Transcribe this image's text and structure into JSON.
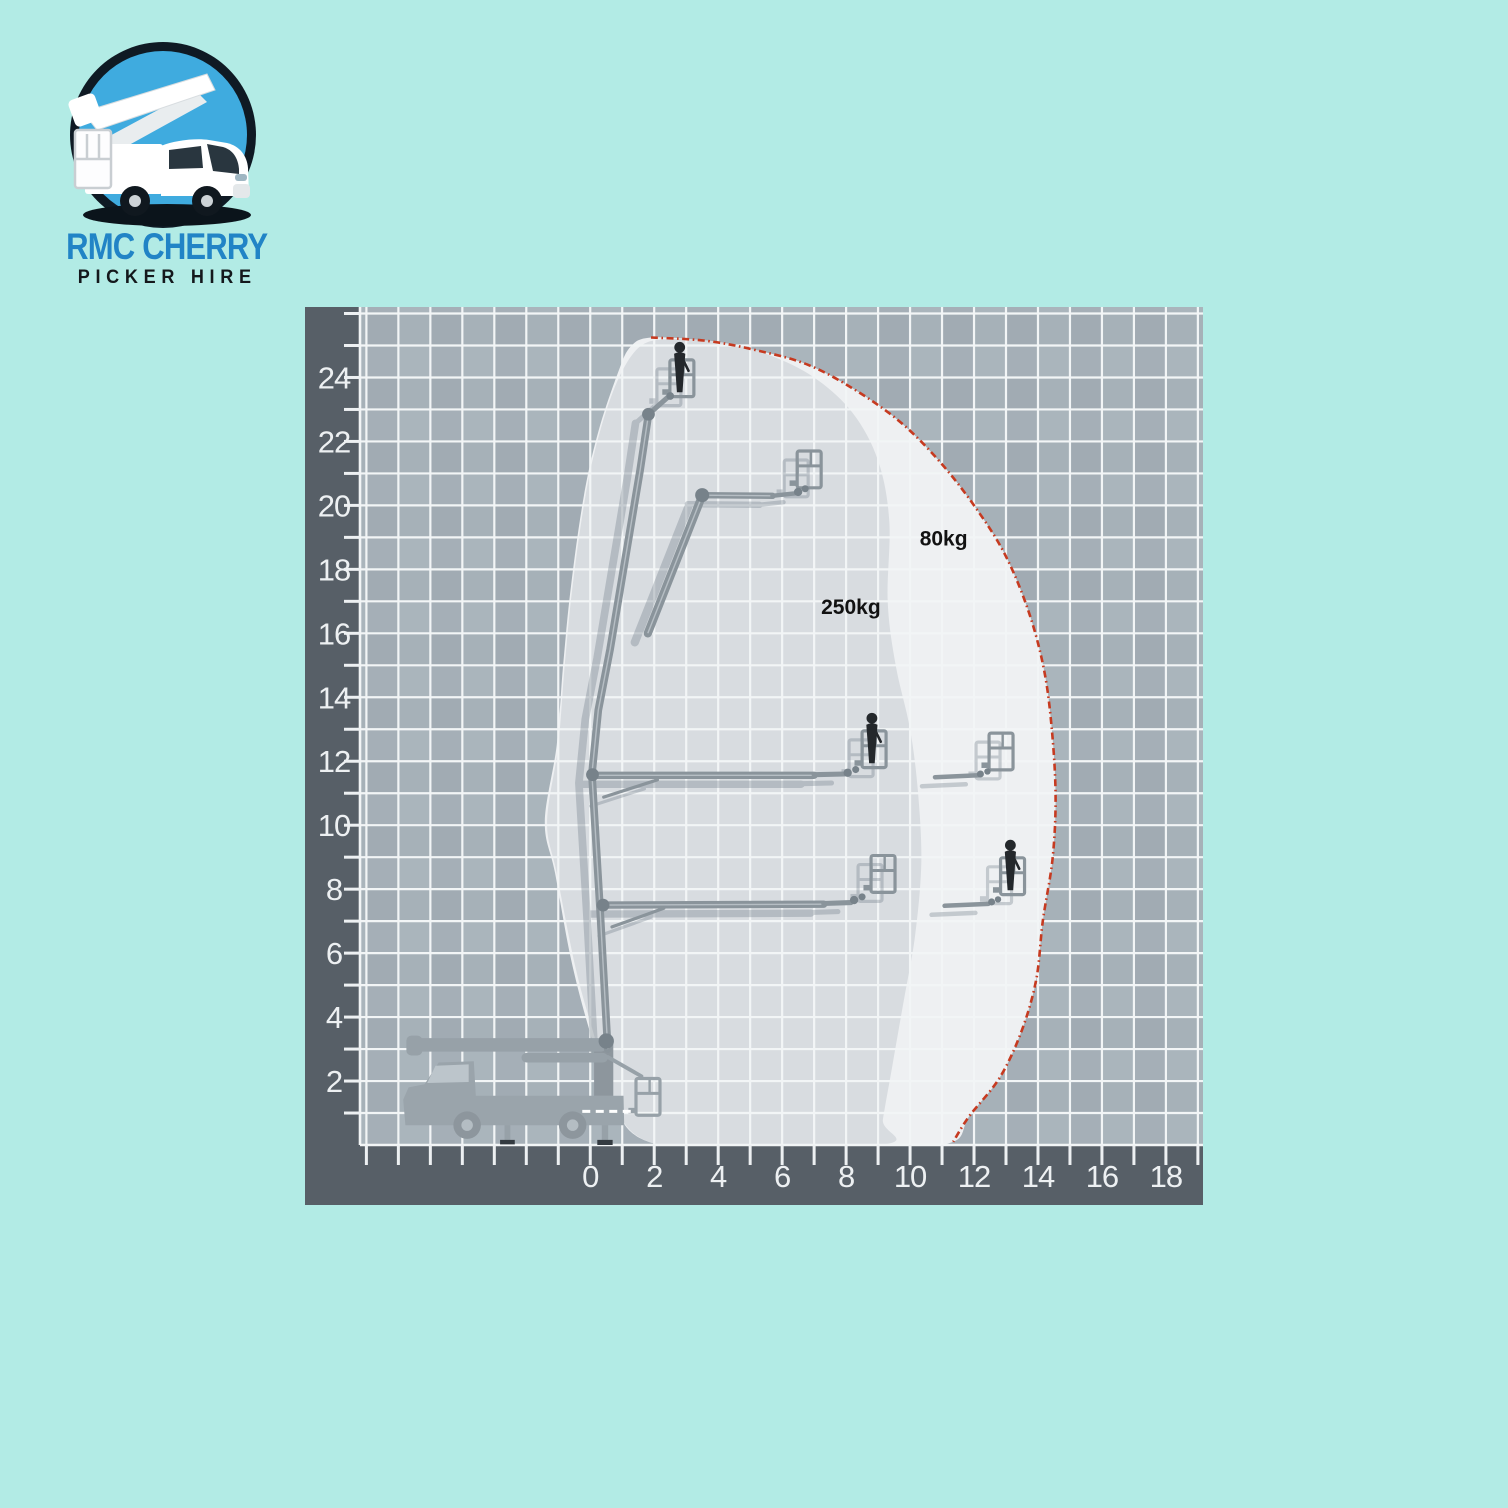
{
  "page": {
    "background": "#b2ebe5"
  },
  "logo": {
    "line1": "RMC CHERRY",
    "line2": "PICKER HIRE",
    "line1_color": "#2184c6",
    "line2_color": "#14181c",
    "circle_fill": "#3fabdf",
    "ring_color": "#0f1a24",
    "truck_color": "#ffffff"
  },
  "chart_data": {
    "type": "area",
    "title": "",
    "xlabel": "",
    "ylabel": "",
    "xlim": [
      -7.2,
      19.16
    ],
    "ylim": [
      0,
      26.19
    ],
    "x_tick_labels": [
      0,
      2,
      4,
      6,
      8,
      10,
      12,
      14,
      16,
      18
    ],
    "y_tick_labels": [
      2,
      4,
      6,
      8,
      10,
      12,
      14,
      16,
      18,
      20,
      22,
      24
    ],
    "minor_tick_step": 1,
    "grid": "on",
    "legend_position": "none",
    "colors": {
      "band": "#575f67",
      "grid_bg": "#aab5bc",
      "grid_line": "#f2f5f6",
      "tick_text": "#edf0f2",
      "limit_line": "#c63a20",
      "label_text": "#121212",
      "machine": "#8a949b",
      "machine_light": "#97a1a8",
      "truck": "#9aa4ab",
      "joint": "#77828a",
      "person": "#24282c",
      "shadow": "#6c7884"
    },
    "zones": [
      {
        "name": "80kg",
        "label": "80kg",
        "label_pos": [
          11.05,
          18.75
        ],
        "fill": "#eef0f2",
        "points": [
          [
            1.9,
            25.25
          ],
          [
            3.6,
            25.15
          ],
          [
            5.2,
            24.85
          ],
          [
            6.8,
            24.4
          ],
          [
            8.3,
            23.6
          ],
          [
            9.7,
            22.6
          ],
          [
            10.9,
            21.4
          ],
          [
            12.0,
            20.0
          ],
          [
            12.95,
            18.5
          ],
          [
            13.7,
            16.7
          ],
          [
            14.2,
            14.8
          ],
          [
            14.45,
            12.8
          ],
          [
            14.55,
            10.8
          ],
          [
            14.45,
            8.9
          ],
          [
            14.15,
            7.0
          ],
          [
            13.95,
            5.2
          ],
          [
            13.5,
            3.6
          ],
          [
            12.8,
            2.1
          ],
          [
            11.85,
            0.9
          ],
          [
            11.35,
            0.1
          ],
          [
            9.5,
            0
          ],
          [
            2.2,
            0
          ],
          [
            0.6,
            1.8
          ],
          [
            0.0,
            3.5
          ],
          [
            -0.6,
            5.8
          ],
          [
            -1.1,
            8.5
          ],
          [
            -1.42,
            10.1
          ],
          [
            -1.05,
            12.5
          ],
          [
            -0.85,
            15.0
          ],
          [
            -0.6,
            17.5
          ],
          [
            -0.2,
            20.3
          ],
          [
            0.25,
            22.3
          ],
          [
            0.85,
            24.1
          ],
          [
            1.25,
            24.95
          ]
        ]
      },
      {
        "name": "250kg",
        "label": "250kg",
        "label_pos": [
          8.15,
          16.6
        ],
        "fill": "#d8dce0",
        "points": [
          [
            2.2,
            0
          ],
          [
            0.6,
            1.8
          ],
          [
            0.1,
            3.5
          ],
          [
            -0.45,
            5.5
          ],
          [
            -1.05,
            8.5
          ],
          [
            -1.35,
            10.1
          ],
          [
            -1.0,
            12.5
          ],
          [
            -0.8,
            15.0
          ],
          [
            -0.55,
            17.5
          ],
          [
            -0.15,
            20.3
          ],
          [
            0.3,
            22.3
          ],
          [
            0.9,
            24.0
          ],
          [
            1.6,
            25.0
          ],
          [
            2.6,
            25.2
          ],
          [
            4.1,
            25.1
          ],
          [
            5.6,
            24.7
          ],
          [
            7.0,
            24.0
          ],
          [
            8.2,
            22.9
          ],
          [
            9.0,
            21.4
          ],
          [
            9.35,
            19.5
          ],
          [
            9.3,
            17.0
          ],
          [
            9.55,
            15.0
          ],
          [
            10.0,
            13.0
          ],
          [
            10.25,
            11.0
          ],
          [
            10.35,
            8.8
          ],
          [
            10.15,
            6.5
          ],
          [
            9.8,
            4.5
          ],
          [
            9.45,
            2.5
          ],
          [
            9.15,
            0.8
          ],
          [
            9.05,
            0
          ]
        ]
      }
    ],
    "outline_points": [
      [
        1.9,
        25.25
      ],
      [
        3.6,
        25.15
      ],
      [
        5.2,
        24.85
      ],
      [
        6.8,
        24.4
      ],
      [
        8.3,
        23.6
      ],
      [
        9.7,
        22.6
      ],
      [
        10.9,
        21.4
      ],
      [
        12.0,
        20.0
      ],
      [
        12.95,
        18.5
      ],
      [
        13.7,
        16.7
      ],
      [
        14.2,
        14.8
      ],
      [
        14.45,
        12.8
      ],
      [
        14.55,
        10.8
      ],
      [
        14.45,
        8.9
      ],
      [
        14.15,
        7.0
      ],
      [
        13.95,
        5.2
      ],
      [
        13.5,
        3.6
      ],
      [
        12.8,
        2.1
      ],
      [
        11.85,
        0.9
      ],
      [
        11.35,
        0.1
      ]
    ],
    "machine": {
      "booms": [
        {
          "pts": [
            [
              0.55,
              3.0
            ],
            [
              0.3,
              7.45
            ],
            [
              0.05,
              11.6
            ],
            [
              0.25,
              13.6
            ],
            [
              0.62,
              15.5
            ],
            [
              1.56,
              21.1
            ],
            [
              1.82,
              22.85
            ]
          ],
          "w": 0.24
        },
        {
          "pts": [
            [
              1.82,
              22.85
            ],
            [
              2.5,
              23.45
            ]
          ],
          "w": 0.16
        },
        {
          "pts": [
            [
              1.8,
              16.0
            ],
            [
              3.46,
              20.2
            ]
          ],
          "w": 0.26
        },
        {
          "pts": [
            [
              3.46,
              20.32
            ],
            [
              5.7,
              20.3
            ]
          ],
          "w": 0.2
        },
        {
          "pts": [
            [
              5.7,
              20.3
            ],
            [
              6.45,
              20.38
            ]
          ],
          "w": 0.14
        },
        {
          "pts": [
            [
              0.08,
              11.56
            ],
            [
              7.0,
              11.56
            ]
          ],
          "w": 0.23
        },
        {
          "pts": [
            [
              7.0,
              11.58
            ],
            [
              7.95,
              11.6
            ]
          ],
          "w": 0.16
        },
        {
          "pts": [
            [
              0.42,
              10.88
            ],
            [
              2.1,
              11.42
            ]
          ],
          "w": 0.1
        },
        {
          "pts": [
            [
              10.78,
              11.5
            ],
            [
              12.15,
              11.56
            ]
          ],
          "w": 0.14
        },
        {
          "pts": [
            [
              0.38,
              7.5
            ],
            [
              7.3,
              7.53
            ]
          ],
          "w": 0.23
        },
        {
          "pts": [
            [
              7.3,
              7.55
            ],
            [
              8.15,
              7.58
            ]
          ],
          "w": 0.16
        },
        {
          "pts": [
            [
              0.68,
              6.82
            ],
            [
              2.3,
              7.4
            ]
          ],
          "w": 0.1
        },
        {
          "pts": [
            [
              11.08,
              7.48
            ],
            [
              12.45,
              7.54
            ]
          ],
          "w": 0.14
        }
      ],
      "joints": [
        [
          1.82,
          22.85,
          0.2
        ],
        [
          2.5,
          23.42,
          0.12
        ],
        [
          3.5,
          20.32,
          0.22
        ],
        [
          6.5,
          20.42,
          0.13
        ],
        [
          6.72,
          20.52,
          0.11
        ],
        [
          0.07,
          11.58,
          0.2
        ],
        [
          8.05,
          11.64,
          0.13
        ],
        [
          8.3,
          11.74,
          0.11
        ],
        [
          12.2,
          11.6,
          0.11
        ],
        [
          12.42,
          11.68,
          0.1
        ],
        [
          0.4,
          7.5,
          0.2
        ],
        [
          8.25,
          7.66,
          0.13
        ],
        [
          8.5,
          7.76,
          0.11
        ],
        [
          12.55,
          7.6,
          0.11
        ],
        [
          12.75,
          7.68,
          0.1
        ],
        [
          0.5,
          3.25,
          0.24
        ]
      ],
      "baskets": [
        {
          "x": 2.44,
          "y": 23.35,
          "person": true
        },
        {
          "x": 6.42,
          "y": 20.5,
          "person": false
        },
        {
          "x": 8.45,
          "y": 11.75,
          "person": true
        },
        {
          "x": 12.42,
          "y": 11.68,
          "person": false
        },
        {
          "x": 8.73,
          "y": 7.85,
          "person": false
        },
        {
          "x": 12.78,
          "y": 7.78,
          "person": true
        }
      ],
      "truck": {
        "body": [
          [
            -5.78,
            0.62
          ],
          [
            -5.85,
            1.42
          ],
          [
            -5.68,
            1.8
          ],
          [
            -5.18,
            1.9
          ],
          [
            -4.74,
            2.58
          ],
          [
            -3.64,
            2.62
          ],
          [
            -3.58,
            1.54
          ],
          [
            1.04,
            1.54
          ],
          [
            1.06,
            0.62
          ]
        ],
        "window": [
          [
            -5.1,
            1.94
          ],
          [
            -4.84,
            2.48
          ],
          [
            -3.8,
            2.52
          ],
          [
            -3.8,
            1.97
          ]
        ],
        "wheels": [
          [
            -3.85,
            0.62,
            0.43
          ],
          [
            -0.55,
            0.62,
            0.43
          ]
        ],
        "pedestal": [
          0.12,
          1.54,
          0.6,
          1.75
        ],
        "bars": [
          [
            -5.5,
            2.92,
            6.0,
            0.42
          ],
          [
            -2.15,
            2.58,
            2.7,
            0.3
          ],
          [
            -5.75,
            2.8,
            0.5,
            0.62
          ]
        ],
        "link": [
          [
            0.55,
            2.75
          ],
          [
            1.6,
            2.15
          ]
        ],
        "basket": {
          "x": 1.38,
          "y": 0.88
        },
        "dash_line": [
          [
            -0.25,
            1.05
          ],
          [
            1.32,
            1.05
          ]
        ],
        "outriggers": [
          [
            -2.68,
            0.1,
            0.18,
            1.0
          ],
          [
            0.36,
            0.08,
            0.2,
            1.25
          ]
        ],
        "pads": [
          [
            -2.82,
            0.02,
            0.46,
            0.14
          ],
          [
            0.22,
            0.0,
            0.48,
            0.16
          ]
        ]
      }
    }
  }
}
